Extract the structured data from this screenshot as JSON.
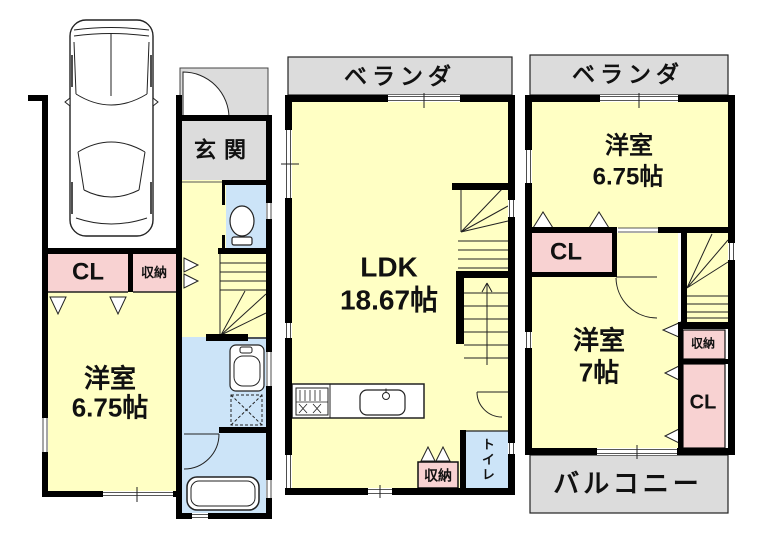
{
  "plan_title": "3-story house floor plan",
  "colors": {
    "room_yellow": "#FFFFC4",
    "closet_pink": "#F8D2D2",
    "wet_blue": "#CCE4F8",
    "outdoor_gray": "#DCDCDC",
    "wall_black": "#000000"
  },
  "floor1": {
    "entrance": "玄関",
    "closet": "CL",
    "storage": "収納",
    "room": "洋室",
    "room_size": "6.75帖"
  },
  "floor2": {
    "veranda": "ベランダ",
    "room": "LDK",
    "room_size": "18.67帖",
    "storage": "収納",
    "toilet": "トイレ"
  },
  "floor3": {
    "veranda": "ベランダ",
    "room1": "洋室",
    "room1_size": "6.75帖",
    "closet1": "CL",
    "room2": "洋室",
    "room2_size": "7帖",
    "storage": "収納",
    "closet2": "CL",
    "balcony": "バルコニー"
  }
}
